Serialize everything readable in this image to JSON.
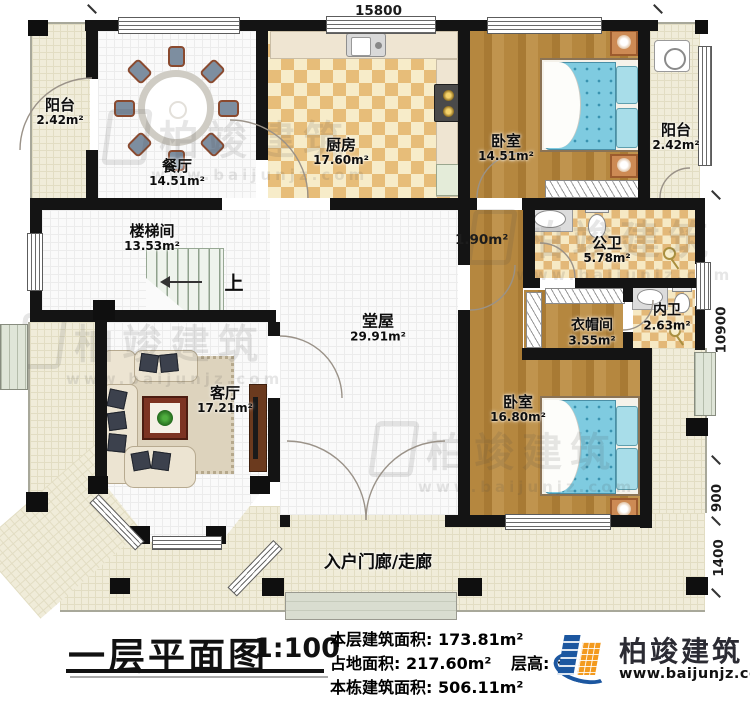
{
  "dims": {
    "top_width": "15800",
    "right_height": "10900",
    "right_offset_upper": "900",
    "right_offset_lower": "1400",
    "corridor_width": "1.90m²"
  },
  "rooms": {
    "balcony_left": {
      "name": "阳台",
      "area": "2.42m²"
    },
    "dining": {
      "name": "餐厅",
      "area": "14.51m²"
    },
    "kitchen": {
      "name": "厨房",
      "area": "17.60m²"
    },
    "bedroom_top": {
      "name": "卧室",
      "area": "14.51m²"
    },
    "balcony_right": {
      "name": "阳台",
      "area": "2.42m²"
    },
    "stair_hall": {
      "name": "楼梯间",
      "area": "13.53m²"
    },
    "main_hall": {
      "name": "堂屋",
      "area": "29.91m²"
    },
    "living": {
      "name": "客厅",
      "area": "17.21m²"
    },
    "public_bath": {
      "name": "公卫",
      "area": "5.78m²"
    },
    "cloakroom": {
      "name": "衣帽间",
      "area": "3.55m²"
    },
    "ensuite_bath": {
      "name": "内卫",
      "area": "2.63m²"
    },
    "bedroom_bottom": {
      "name": "卧室",
      "area": "16.80m²"
    },
    "entry_porch": {
      "name": "入户门廊/走廊"
    },
    "stairs_up_label": "上"
  },
  "title_block": {
    "title": "一层平面图",
    "scale": "1:100",
    "stats": [
      {
        "label": "本层建筑面积:",
        "value": "173.81m²"
      },
      {
        "label": "占地面积:",
        "value": "217.60m²",
        "label2": "层高:",
        "value2": "3"
      },
      {
        "label": "本栋建筑面积:",
        "value": "506.11m²"
      }
    ]
  },
  "branding": {
    "company": "柏竣建筑",
    "website": "www.baijunjz.com"
  },
  "watermark": {
    "text": "柏竣建筑",
    "url": "www.baijunjz.com"
  },
  "colors": {
    "wall": "#141414",
    "brand_blue": "#1c57a0",
    "brand_orange": "#f39a1e",
    "floor_wood": "#b5873f",
    "floor_cream": "#f0ecd9",
    "bed_blue": "#7fcbe0"
  }
}
